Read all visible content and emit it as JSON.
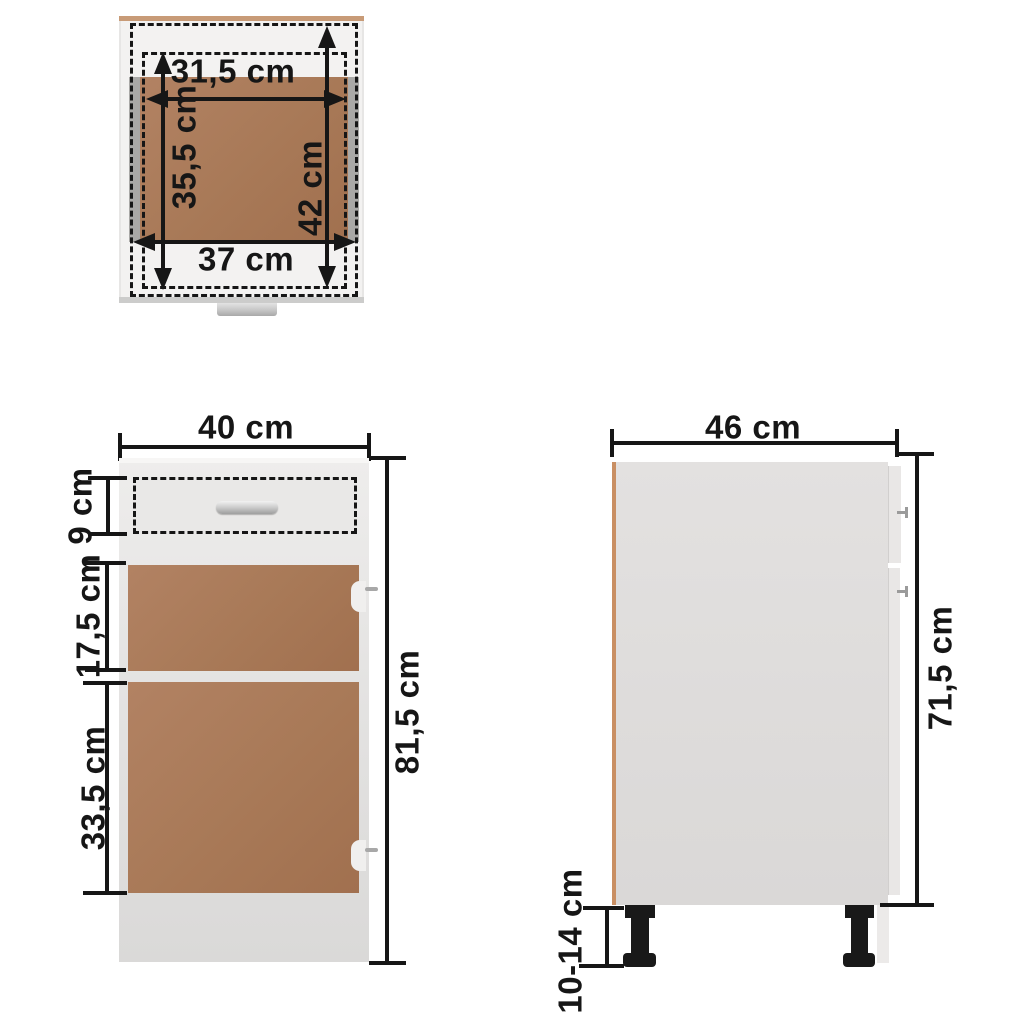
{
  "title": "Kitchen base cabinet with drawer — dimension diagram",
  "views": {
    "top": {
      "name": "Top view (drawer plan)",
      "measurements": {
        "drawer_inner_width": "31,5 cm",
        "drawer_inner_depth": "35,5 cm",
        "drawer_outer_depth": "42 cm",
        "cabinet_inner_width": "37 cm"
      }
    },
    "front": {
      "name": "Front view",
      "measurements": {
        "cabinet_width": "40 cm",
        "drawer_front_height": "9 cm",
        "upper_door_height": "17,5 cm",
        "lower_door_height": "33,5 cm",
        "total_height": "81,5 cm"
      }
    },
    "side": {
      "name": "Side view",
      "measurements": {
        "cabinet_depth": "46 cm",
        "body_height": "71,5 cm",
        "leg_height": "10-14 cm"
      }
    }
  },
  "colors": {
    "background": "#ffffff",
    "dimension_ink": "#161616",
    "panel_brown": "#a87957",
    "cabinet_white": "#e7e6e5",
    "side_panel_gray": "#dedcdb",
    "back_edge_tan": "#c89b77",
    "leg_black": "#191919",
    "handle_chrome": "#b9b9b9"
  }
}
